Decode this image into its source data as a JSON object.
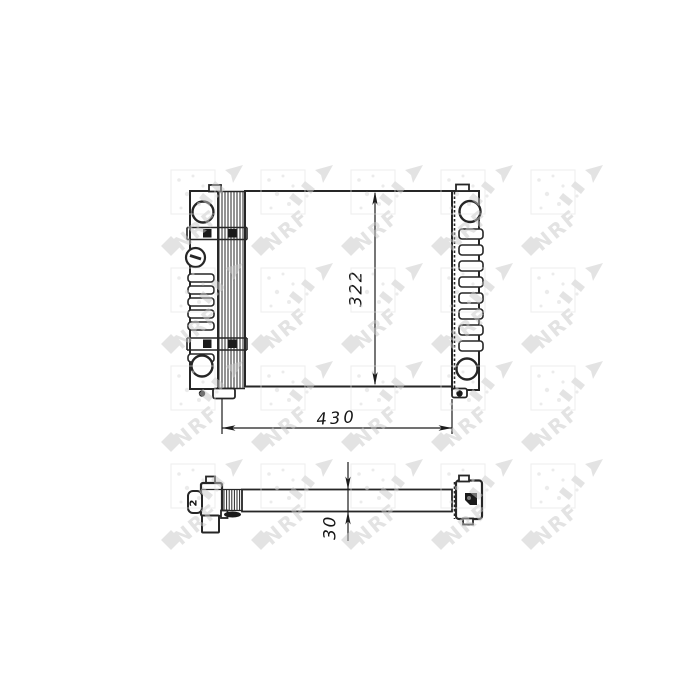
{
  "page": {
    "background_color": "#ffffff"
  },
  "drawing": {
    "subject": "radiator-technical-drawing",
    "line_color": "#262626"
  },
  "dimensions": {
    "height": {
      "value": "322"
    },
    "width": {
      "value": "430"
    },
    "depth": {
      "value": "30"
    }
  },
  "side_view": {
    "left_connector_mark": "2"
  },
  "watermark": {
    "text": "NRF",
    "color": "#c4c4c4"
  }
}
